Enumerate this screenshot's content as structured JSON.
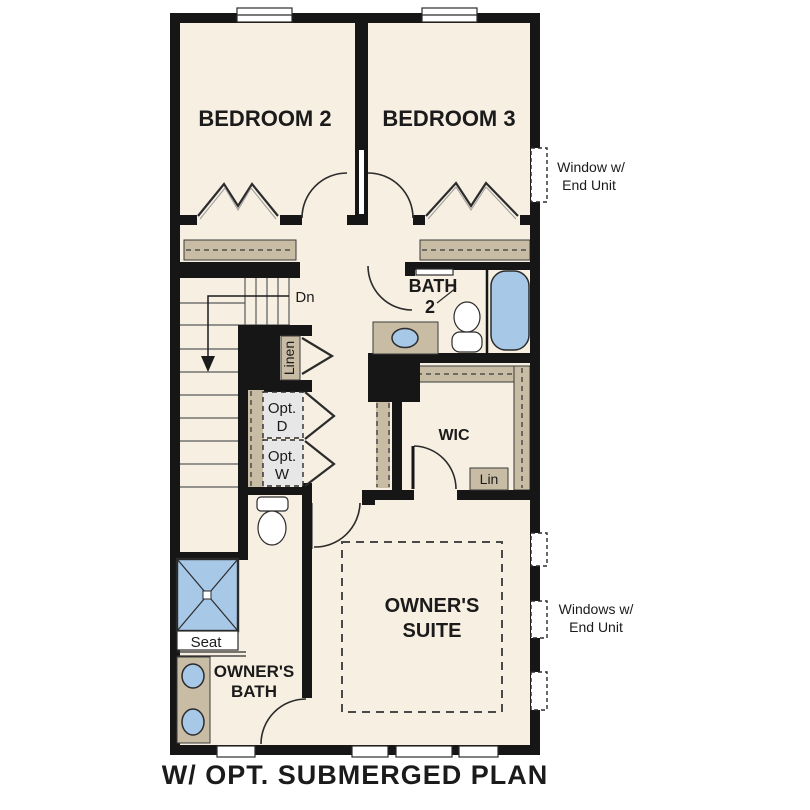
{
  "plan": {
    "title": "W/ OPT. SUBMERGED PLAN",
    "rooms": {
      "bedroom2": "BEDROOM 2",
      "bedroom3": "BEDROOM 3",
      "bath2_line1": "BATH",
      "bath2_line2": "2",
      "wic": "WIC",
      "owners_suite_line1": "OWNER'S",
      "owners_suite_line2": "SUITE",
      "owners_bath_line1": "OWNER'S",
      "owners_bath_line2": "BATH"
    },
    "labels": {
      "dn": "Dn",
      "linen": "Linen",
      "opt_d_line1": "Opt.",
      "opt_d_line2": "D",
      "opt_w_line1": "Opt.",
      "opt_w_line2": "W",
      "lin": "Lin",
      "seat": "Seat"
    },
    "annotations": {
      "window_end_unit_line1": "Window w/",
      "window_end_unit_line2": "End Unit",
      "windows_end_unit_line1": "Windows w/",
      "windows_end_unit_line2": "End Unit"
    },
    "colors": {
      "wall": "#161616",
      "floor": "#f7efe2",
      "shelf": "#c9bca4",
      "fixture_blue": "#a8c8e8",
      "appliance_gray": "#e7e7e7"
    }
  }
}
